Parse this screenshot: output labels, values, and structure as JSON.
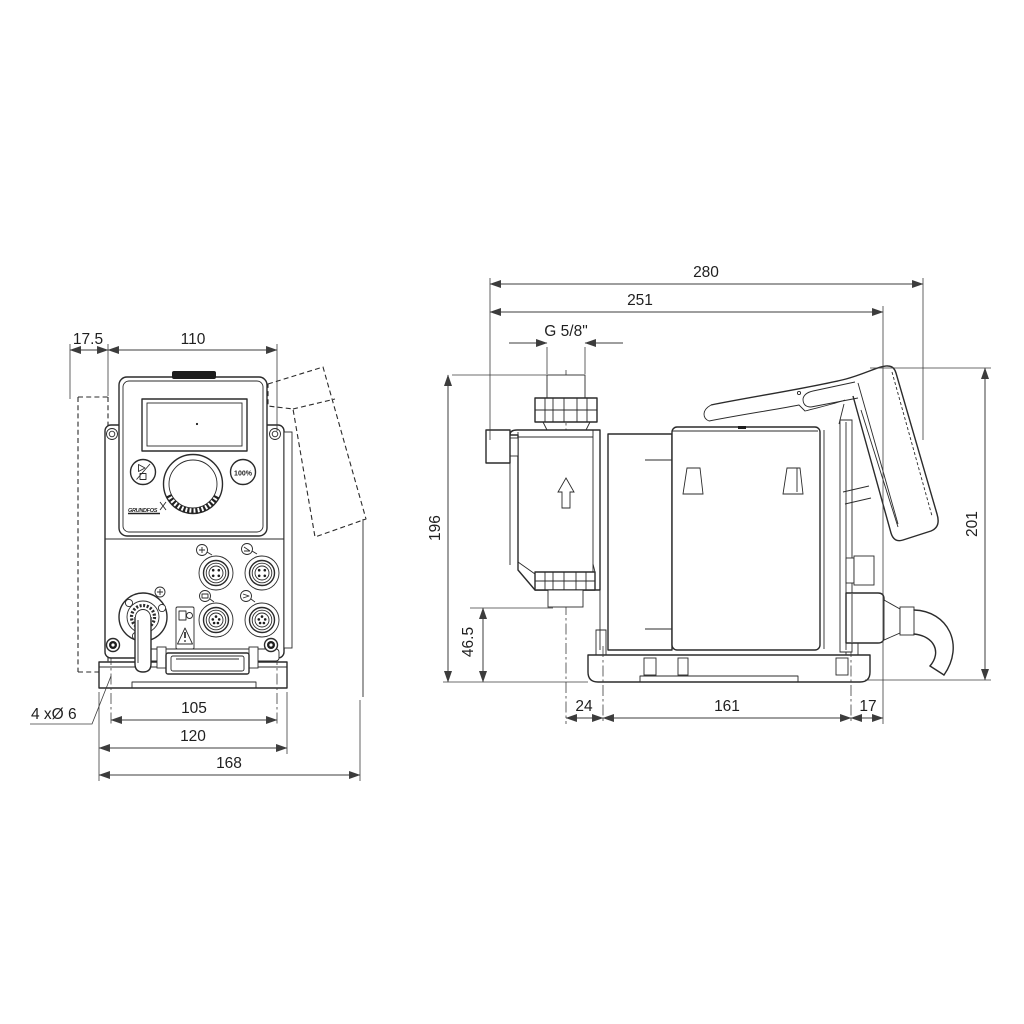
{
  "front": {
    "dims": {
      "wall_offset": "17.5",
      "width": "110",
      "holes_note": "4 xØ 6",
      "hole_spacing": "105",
      "plate_width": "120",
      "total_width": "168"
    },
    "panel": {
      "percent_button": "100%",
      "logo": "GRUNDFOS"
    }
  },
  "side": {
    "dims": {
      "total_depth": "280",
      "depth_to_cable": "251",
      "connection_thread": "G 5/8\"",
      "height_to_connection": "196",
      "height_to_suction_valve": "46.5",
      "front_hole_offset": "24",
      "hole_spacing": "161",
      "rear_overhang": "17",
      "total_height": "201"
    }
  },
  "colors": {
    "line": "#2b2b2b",
    "dimension": "#3c3c3c",
    "background": "#ffffff"
  }
}
